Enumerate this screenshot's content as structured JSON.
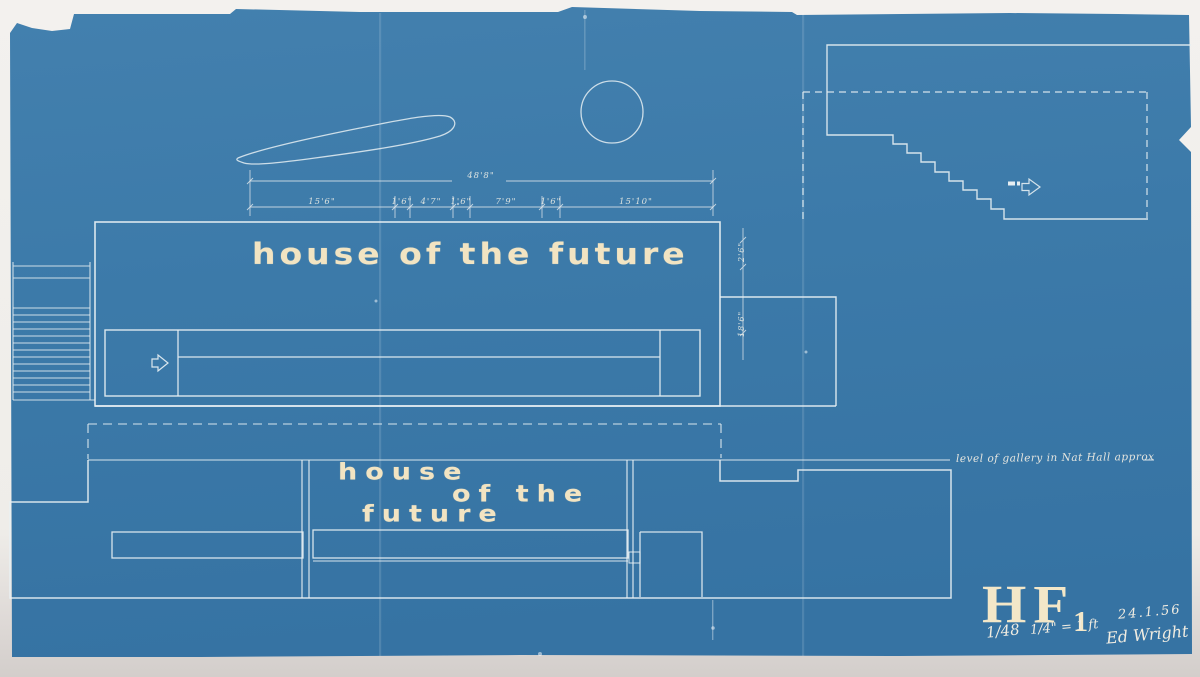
{
  "colors": {
    "blueprint_blue": "#3C7AA9",
    "line_white": "#E8F0F3",
    "lettering_cream": "#F2E4C2",
    "paper": "#EFEDEA"
  },
  "titles": {
    "upper": "house of the future",
    "lower_line1": "house",
    "lower_line2": "of the",
    "lower_line3": "future"
  },
  "dimensions": {
    "overall_width": "48'8\"",
    "segments": [
      "15'6\"",
      "1'6\"",
      "4'7\"",
      "1'6\"",
      "7'9\"",
      "1'6\"",
      "15'10\""
    ],
    "height_upper": "2'6\"",
    "height_lower": "18'6\""
  },
  "annotations": {
    "gallery_level": "level of gallery in Nat Hall approx"
  },
  "title_block": {
    "drawing_code": "HF",
    "drawing_number": "1",
    "date": "24.1.56",
    "scale_ratio": "1/48",
    "scale_note": "1/4\" = 1 ft",
    "signature": "Ed Wright"
  },
  "icons": {
    "stair_direction": "arrow-right-icon",
    "entry_direction": "arrow-right-icon"
  }
}
